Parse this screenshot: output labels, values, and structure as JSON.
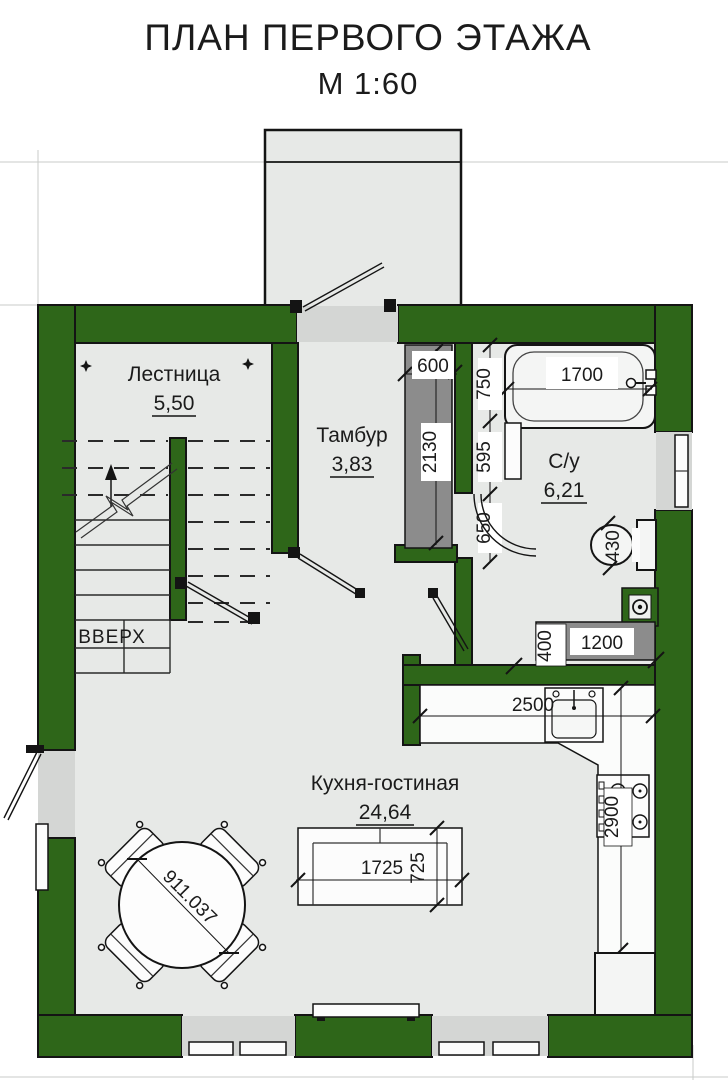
{
  "title": {
    "line1": "ПЛАН ПЕРВОГО ЭТАЖА",
    "line2": "М 1:60"
  },
  "rooms": {
    "staircase": {
      "name": "Лестница",
      "area": "5,50"
    },
    "vestibule": {
      "name": "Тамбур",
      "area": "3,83"
    },
    "bathroom": {
      "name": "С/у",
      "area": "6,21"
    },
    "kitchen_living": {
      "name": "Кухня-гостиная",
      "area": "24,64"
    }
  },
  "stairs": {
    "direction_label": "ВВЕРХ"
  },
  "dims": {
    "closet_width": "600",
    "closet_depth": "2130",
    "bath_length": "1700",
    "wall_seg_tub": "750",
    "wall_seg_basin": "595",
    "door_opening": "650",
    "toilet_width": "430",
    "counter_depth": "400",
    "counter_length": "1200",
    "worktop_length": "2500",
    "worktop_run": "2900",
    "sofa_length": "1725",
    "sofa_depth": "725",
    "table_diameter": "911.037"
  },
  "colors": {
    "wall": "#2e6619",
    "floor": "#e7e9e7",
    "recess": "#d4d6d4",
    "counter_gray": "#8c8c8c"
  }
}
